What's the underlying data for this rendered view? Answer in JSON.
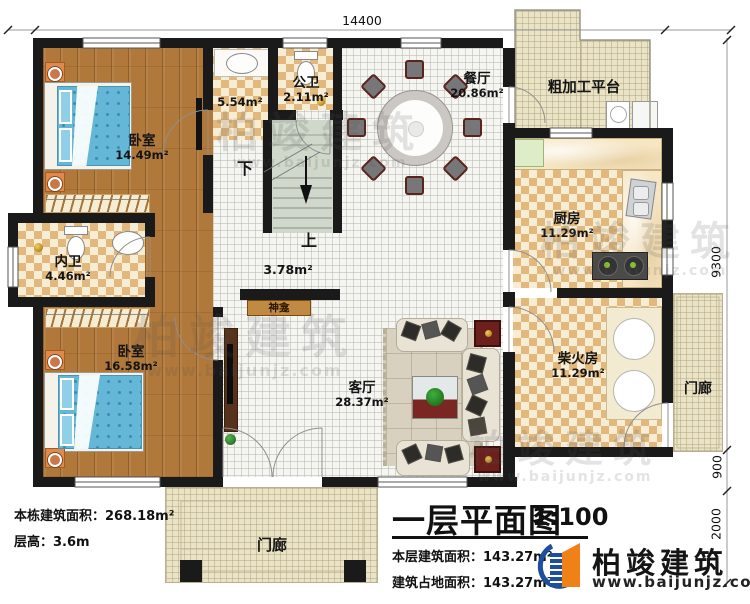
{
  "dims": {
    "top": "14400",
    "right1": "9300",
    "right2": "900",
    "right3": "2000"
  },
  "labels": {
    "bedroom1_name": "卧室",
    "bedroom1_area": "14.49m²",
    "wash_area": "5.54m²",
    "pubbath_name": "公卫",
    "pubbath_area": "2.11m²",
    "dining_name": "餐厅",
    "dining_area": "20.86m²",
    "platform_name": "粗加工平台",
    "kitchen_name": "厨房",
    "kitchen_area": "11.29m²",
    "innerbath_name": "内卫",
    "innerbath_area": "4.46m²",
    "bedroom2_name": "卧室",
    "bedroom2_area": "16.58m²",
    "firewood_name": "柴火房",
    "firewood_area": "11.29m²",
    "living_name": "客厅",
    "living_area": "28.37m²",
    "hall_area": "3.78m²",
    "shrine": "神龛",
    "stair_down": "下",
    "stair_up": "上",
    "porch_front": "门廊",
    "porch_right": "门廊"
  },
  "info": {
    "building_area": "本栋建筑面积：268.18m²",
    "floor_height": "层高：3.6m"
  },
  "title_block": {
    "title": "一层平面图",
    "scale": "1:100",
    "floor_area": "本层建筑面积：143.27m²",
    "footprint_area": "建筑占地面积：143.27m²"
  },
  "brand": {
    "name": "柏竣建筑",
    "url": "www.baijunjz.com"
  },
  "watermark": {
    "name": "柏竣建筑",
    "url": "www.baijunjz.com"
  },
  "colors": {
    "wall": "#1a1a1a",
    "wood": "#b0783a",
    "checker_dark": "#e2b87d",
    "checker_light": "#f7ecd4",
    "cream": "#ebe3c6",
    "floor": "#f5f5f2",
    "stair": "#cfd8ca",
    "bed_blue": "#64b7d6",
    "maroon": "#70211d",
    "brand_blue": "#1d4f9e",
    "brand_orange": "#f08018"
  }
}
